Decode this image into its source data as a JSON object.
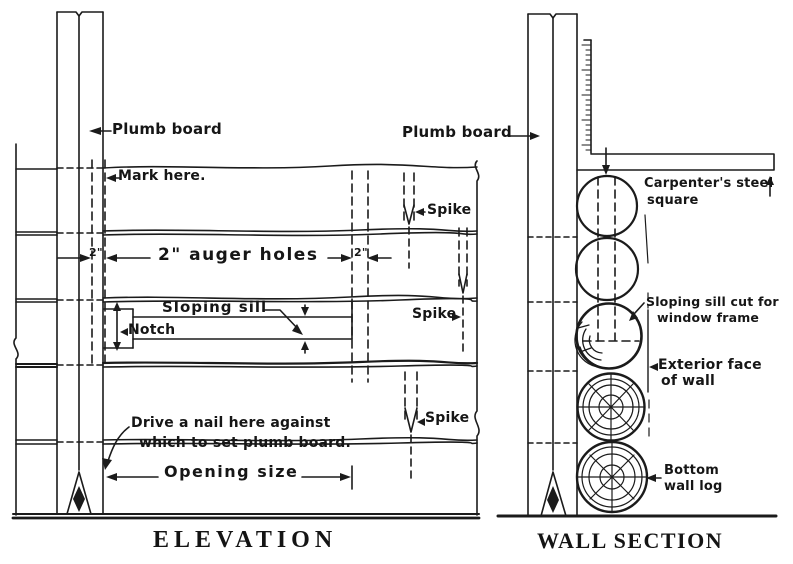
{
  "figure": {
    "elevation": {
      "title": "ELEVATION",
      "labels": {
        "plumb_board": "Plumb board",
        "mark_here": "Mark here.",
        "auger_holes": "2\" auger holes",
        "dim_left": "2\"",
        "dim_right": "2\"",
        "sloping_sill": "Sloping sill",
        "notch": "Notch",
        "spike_top": "Spike",
        "spike_middle": "Spike",
        "spike_bottom": "Spike",
        "drive_nail_line1": "Drive a nail here against",
        "drive_nail_line2": "which to set plumb board.",
        "opening_size": "Opening size"
      }
    },
    "wall_section": {
      "title": "WALL SECTION",
      "labels": {
        "plumb_board": "Plumb board",
        "square_line1": "Carpenter's steel",
        "square_line2": "square",
        "sill_cut_line1": "Sloping sill cut for",
        "sill_cut_line2": "window frame",
        "exterior_line1": "Exterior face",
        "exterior_line2": "of wall",
        "bottom_log_line1": "Bottom",
        "bottom_log_line2": "wall log"
      }
    },
    "colors": {
      "ink": "#1b1b1b",
      "paper": "#ffffff"
    }
  }
}
